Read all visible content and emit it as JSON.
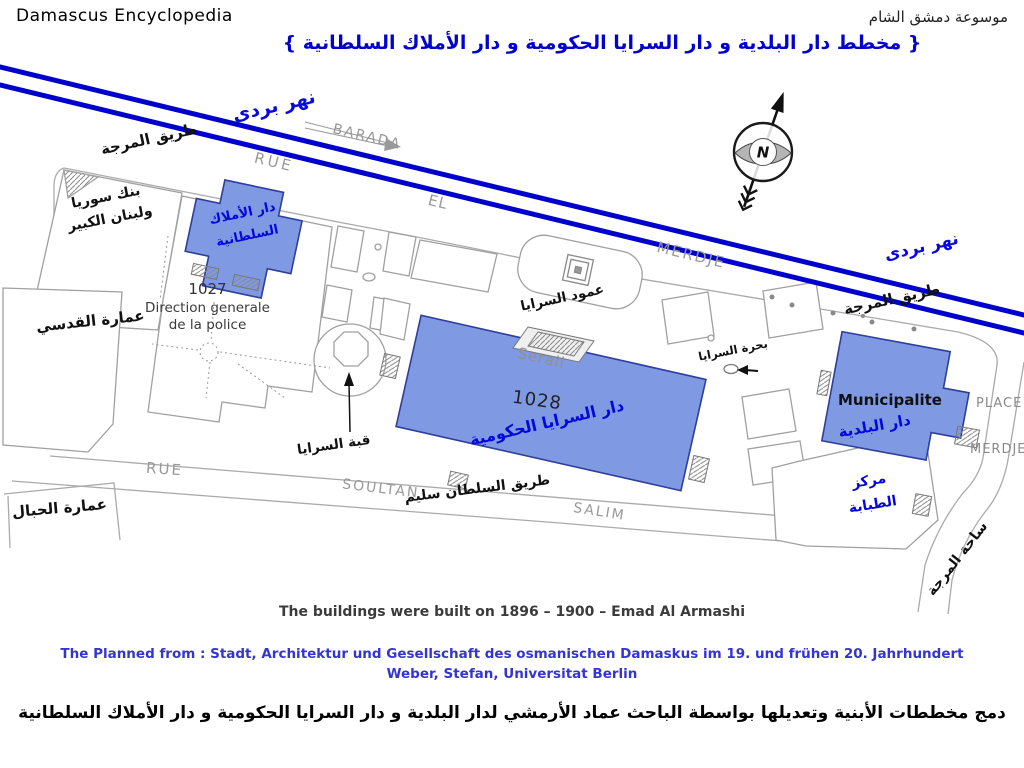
{
  "header": {
    "brand": "Damascus Encyclopedia",
    "publisher_ar": "موسوعة دمشق الشام",
    "title_ar": "{ مخطط دار البلدية و دار السرايا الحكومية  و  دار الأملاك السلطانية }"
  },
  "map": {
    "river": {
      "name_ar": "نهر بردى",
      "name_latin": "BARADA"
    },
    "streets": {
      "marja_road_ar": "طريق المرجة",
      "rue": "RUE",
      "el": "EL",
      "merdje": "MERDJE",
      "soultan": "SOULTAN",
      "salim": "SALIM",
      "sultan_selim_road_ar": "طريق السلطان سليم",
      "place": "PLACE",
      "merdje_place": "MERDJE'",
      "marja_square_ar": "ساحة المرجة"
    },
    "buildings": {
      "bank_line1_ar": "بنك سوريا",
      "bank_line2_ar": "ولبنان الكبير",
      "qudsi_ar": "عمارة القدسي",
      "hibal_ar": "عمارة الحبال",
      "police_number": "1027",
      "police_line1": "Direction generale",
      "police_line2": "de la police",
      "amlak_line1_ar": "دار الأملاك",
      "amlak_line2_ar": "السلطانية",
      "seraii_name": "Seraii",
      "seraii_number": "1028",
      "seraii_ar": "دار السرايا الحكومية",
      "municipality_name": "Municipalite",
      "municipality_ar": "دار البلدية",
      "medical_line1_ar": "مركز",
      "medical_line2_ar": "الطبابة"
    },
    "landmarks": {
      "saraya_column_ar": "عمود السرايا",
      "saraya_dome_ar": "قبة السرايا",
      "saraya_pool_ar": "بحرة السرايا"
    },
    "compass_north": "N"
  },
  "footer": {
    "built_caption": "The buildings were built on 1896 – 1900  – Emad Al Armashi",
    "source_line1": "The Planned from : Stadt, Architektur und Gesellschaft des osmanischen Damaskus im 19. und frühen 20. Jahrhundert",
    "source_line2": "Weber, Stefan, Universitat Berlin",
    "credit_ar": "دمج مخططات الأبنية وتعديلها بواسطة الباحث عماد الأرمشي لدار البلدية و دار السرايا الحكومية  و  دار الأملاك السلطانية"
  },
  "colors": {
    "river_blue": "#0000cc",
    "building_fill": "#7f99e3",
    "building_stroke": "#2e3f9b",
    "arabic_blue": "#0505dd",
    "street_gray": "#979797",
    "source_blue": "#3434d6"
  }
}
